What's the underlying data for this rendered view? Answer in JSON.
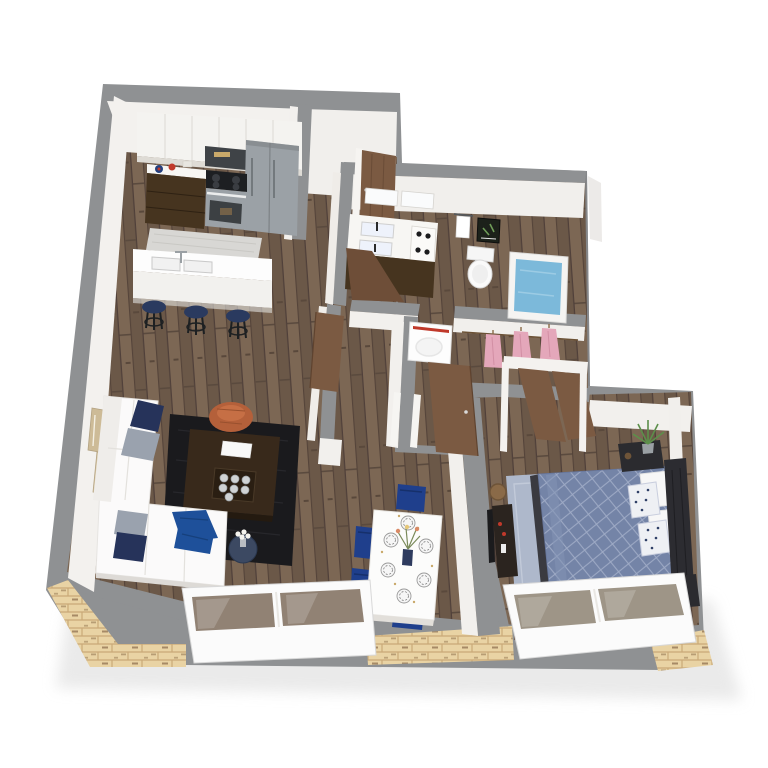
{
  "scene": {
    "title": "3D isometric apartment floor plan rendering",
    "view_label": "Top-down 3D floor plan"
  },
  "palette": {
    "page_bg": "#ffffff",
    "wall_gray": "#8f9193",
    "wall_gray_dark": "#7e8083",
    "wall_face": "#f2f0ed",
    "floor_wood": "#74604e",
    "floor_wood_light": "#7c6754",
    "floor_wood_dark": "#5a4a3e",
    "brick": "#e9d3a4",
    "brick_mortar": "#c9a977",
    "window_frame": "#fbfbfb",
    "glass_tint": "#7e6c5c",
    "island_white": "#fdfdfd",
    "counter_white": "#f7f6f3",
    "cabinet_dark": "#46341f",
    "stainless": "#9ba1a6",
    "appliance_dark": "#3f4347",
    "kitchen_rug": "#d8d7d4",
    "rug_living": "#1a1a1d",
    "rug_bedroom": "#aeb8cb",
    "sofa_white": "#fbfafa",
    "pillow_navy": "#26335a",
    "pillow_gray": "#9aa2ae",
    "throw_blue": "#1e509a",
    "pouf_orange": "#b4603a",
    "coffee_table": "#38291b",
    "side_table_navy": "#3c4962",
    "chair_navy": "#1f3f8c",
    "stool_navy": "#2a3a5f",
    "table_white": "#fcfcfb",
    "duvet_blue": "#7484a7",
    "duvet_line": "#9fabc6",
    "headboard_dark": "#2c2c31",
    "console_dark": "#2b241f",
    "door_brown": "#7b5a42",
    "clothes_pink": "#e4a7ba",
    "tub_water": "#7cb9da",
    "accent_red": "#c0392b",
    "plant_green": "#507d3c",
    "basket_tan": "#8a6a48",
    "gold": "#c9a96a"
  },
  "rooms": {
    "kitchen": {
      "label": "Kitchen",
      "items": "upper cabinets, microwave, range oven, refrigerator, counter, kitchen rug, island with sink, 3 navy bar stools"
    },
    "entry": {
      "label": "Entry hall",
      "items": "wood entry door"
    },
    "bathroom": {
      "label": "Bathroom",
      "items": "double vanity, toilet, bathtub, towel bar, wall art"
    },
    "laundry": {
      "label": "Laundry nook",
      "items": "washer with red stripe"
    },
    "closet": {
      "label": "Walk-in closet",
      "items": "pink hanging clothes, open wood doors"
    },
    "living": {
      "label": "Living room",
      "items": "white sectional sofa, navy and gray pillows, blue throw, dark area rug, coffee table with tray, orange pouf, navy side table with flowers, wall art"
    },
    "dining": {
      "label": "Dining area",
      "items": "white dining table, six place settings, navy chairs, flower vase"
    },
    "bedroom": {
      "label": "Bedroom",
      "items": "bed with slate blue quilted duvet, white and dotted pillows, dark headboard, nightstands, lamp, plants, light blue rug, media console, basket"
    }
  },
  "structure": {
    "exterior_walls_label": "Gray exterior walls",
    "interior_walls_label": "Interior walls and doorways",
    "floors_label": "Hardwood floors",
    "brick_label": "Cut-away brick exterior base",
    "window_living_label": "Living room window wall",
    "window_bedroom_label": "Bedroom window wall"
  }
}
